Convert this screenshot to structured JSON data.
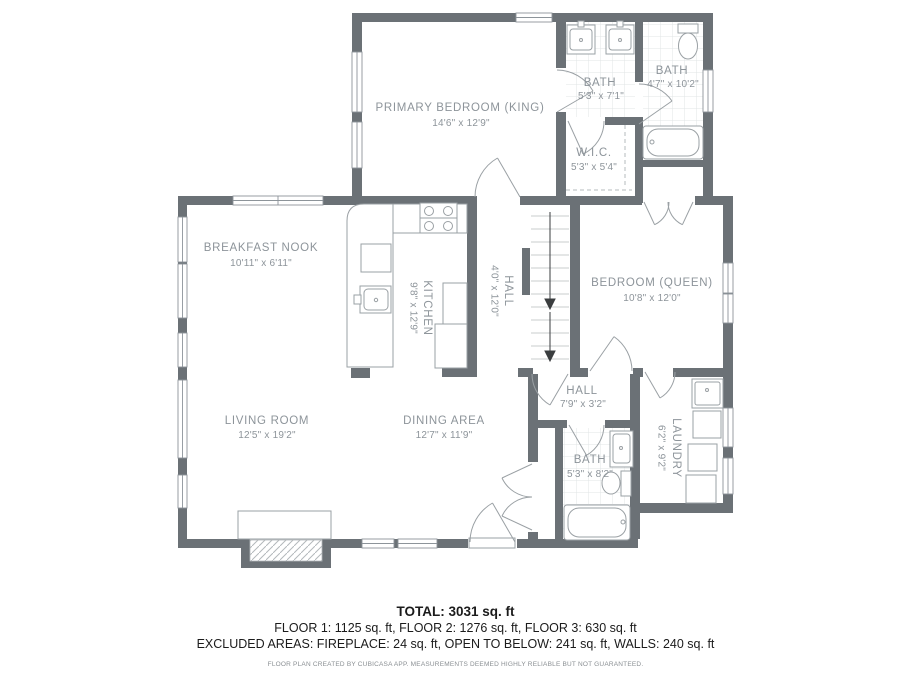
{
  "plan": {
    "rooms": {
      "primary_bedroom": {
        "name": "PRIMARY BEDROOM (KING)",
        "dims": "14'6\" x 12'9\""
      },
      "bath_top_1": {
        "name": "BATH",
        "dims": "5'3\" x 7'1\""
      },
      "bath_top_2": {
        "name": "BATH",
        "dims": "4'7\" x 10'2\""
      },
      "wic": {
        "name": "W.I.C.",
        "dims": "5'3\" x 5'4\""
      },
      "breakfast_nook": {
        "name": "BREAKFAST NOOK",
        "dims": "10'11\" x 6'11\""
      },
      "kitchen": {
        "name": "KITCHEN",
        "dims": "9'8\" x 12'9\""
      },
      "hall_upper": {
        "name": "HALL",
        "dims": "4'0\" x 12'0\""
      },
      "bedroom_queen": {
        "name": "BEDROOM (QUEEN)",
        "dims": "10'8\" x 12'0\""
      },
      "living_room": {
        "name": "LIVING ROOM",
        "dims": "12'5\" x 19'2\""
      },
      "dining_area": {
        "name": "DINING AREA",
        "dims": "12'7\" x 11'9\""
      },
      "hall_lower": {
        "name": "HALL",
        "dims": "7'9\" x 3'2\""
      },
      "bath_lower": {
        "name": "BATH",
        "dims": "5'3\" x 8'2\""
      },
      "laundry": {
        "name": "LAUNDRY",
        "dims": "6'2\" x 9'2\""
      }
    }
  },
  "footer": {
    "total": "TOTAL: 3031 sq. ft",
    "floors": "FLOOR 1: 1125 sq. ft, FLOOR 2: 1276 sq. ft, FLOOR 3: 630 sq. ft",
    "excluded": "EXCLUDED AREAS: FIREPLACE: 24 sq. ft, OPEN TO BELOW: 241 sq. ft, WALLS: 240 sq. ft",
    "disclaimer": "FLOOR PLAN CREATED BY CUBICASA APP. MEASUREMENTS DEEMED HIGHLY RELIABLE BUT NOT GUARANTEED."
  },
  "colors": {
    "wall": "#6b7176",
    "label": "#8d949a",
    "fixture_line": "#9aa0a4",
    "tile_line": "#e1e4e6",
    "stair_tread": "#c8ccce",
    "footer_text": "#1b1b1b",
    "disclaimer_text": "#8a8f93"
  }
}
